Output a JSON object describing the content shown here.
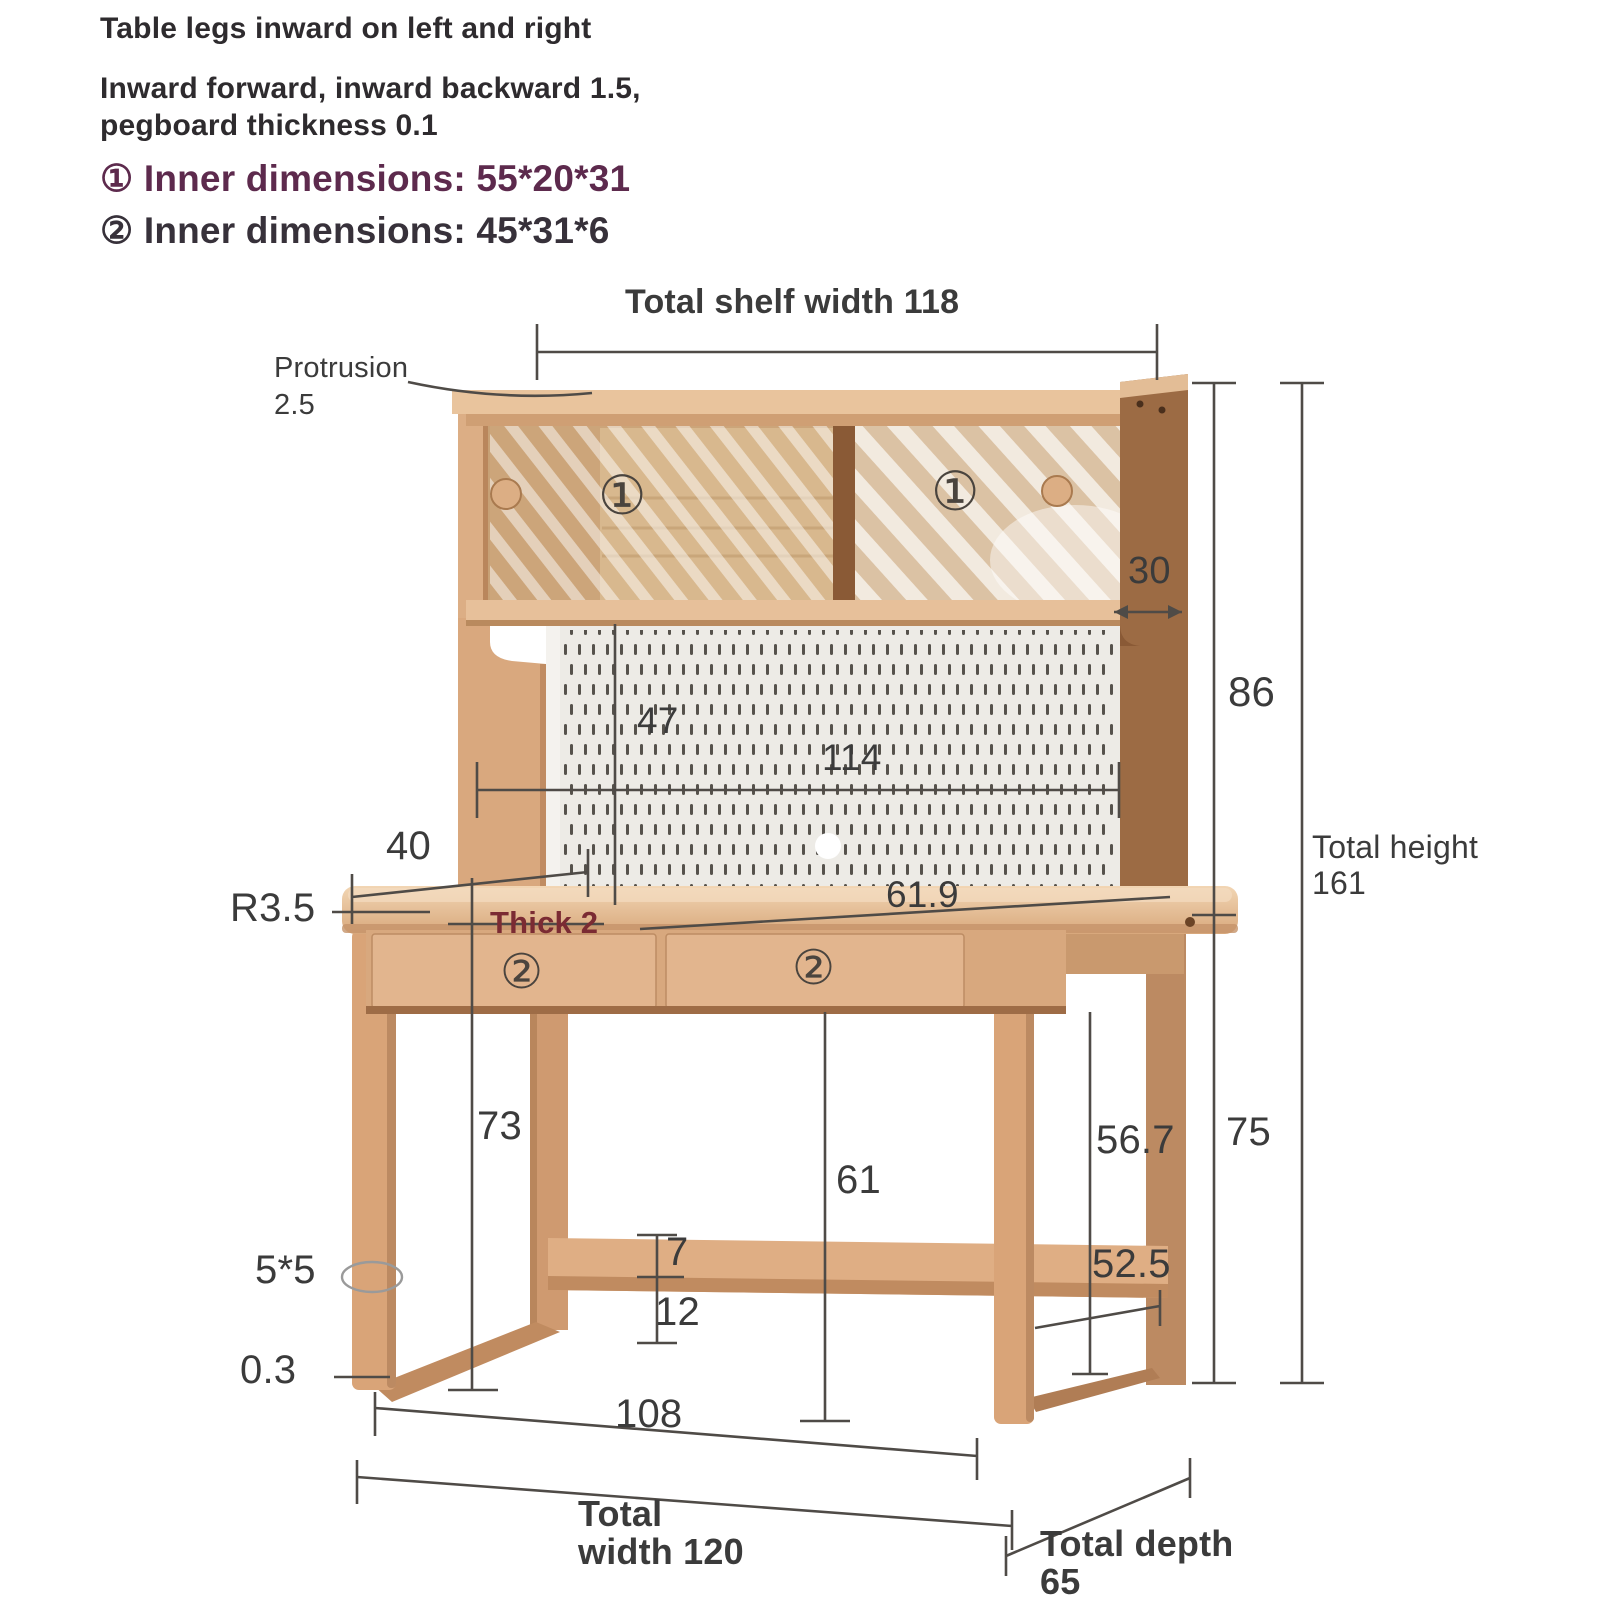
{
  "notes": {
    "line1": "Table legs inward on left and right",
    "line2a": "Inward forward, inward backward 1.5,",
    "line2b": "pegboard thickness 0.1",
    "item1": "① Inner dimensions: 55*20*31",
    "item2": "② Inner dimensions: 45*31*6"
  },
  "dim_labels": {
    "shelf_width": "Total shelf width 118",
    "protrusion_1": "Protrusion",
    "protrusion_2": "2.5",
    "d30": "30",
    "d86": "86",
    "total_height_1": "Total height",
    "total_height_2": "161",
    "d47": "47",
    "d114": "114",
    "d40": "40",
    "r35": "R3.5",
    "thick2": "Thick 2",
    "d619": "61.9",
    "d73": "73",
    "d61": "61",
    "d7": "7",
    "d12": "12",
    "d55": "5*5",
    "d03": "0.3",
    "d567": "56.7",
    "d75": "75",
    "d525": "52.5",
    "d108": "108",
    "total_width_1": "Total",
    "total_width_2": "width 120",
    "total_depth_1": "Total depth",
    "total_depth_2": "65"
  },
  "furniture_markers": {
    "shelf_left": "①",
    "shelf_right": "①",
    "drawer_left": "②",
    "drawer_right": "②"
  },
  "colors": {
    "background": "#ffffff",
    "dimension_line": "#4f4b47",
    "text": "#3b3b3b",
    "accent_purple": "#5d2a4d",
    "accent_maroon": "#7b2b33",
    "wood_light": "#e9c49d",
    "wood_medium": "#d8a87e",
    "wood_dark": "#9c6b44",
    "pegboard": "#edebe6"
  }
}
